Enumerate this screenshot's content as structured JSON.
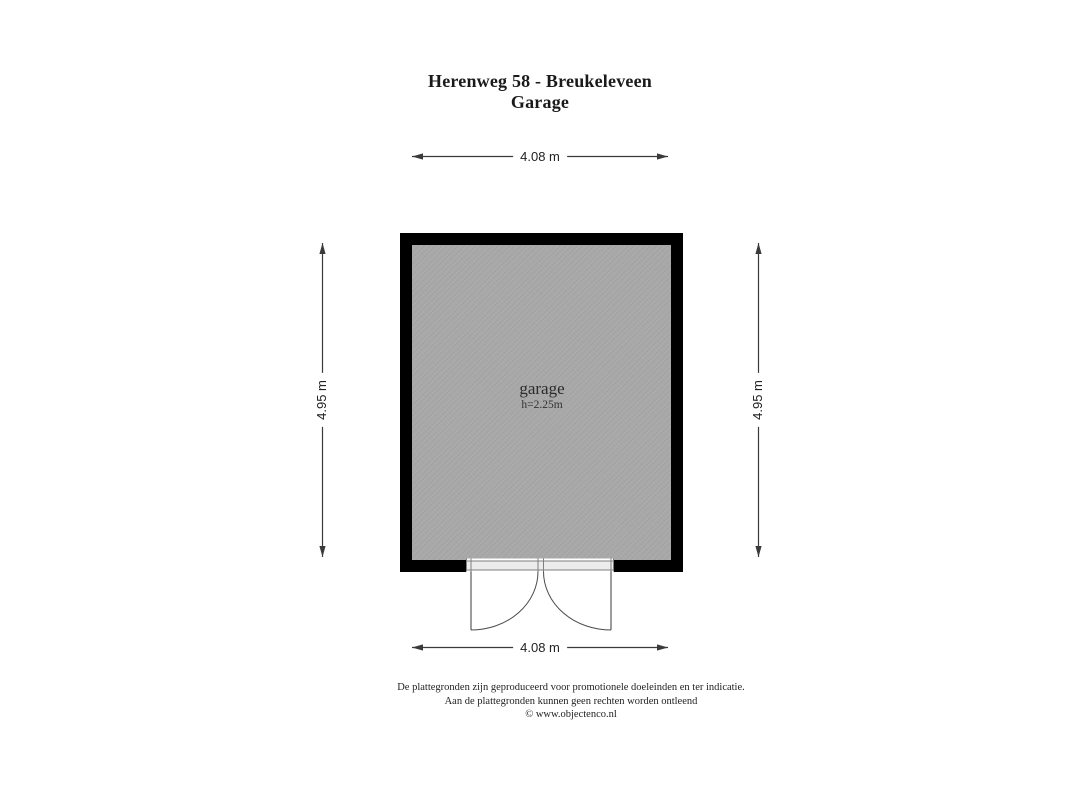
{
  "title": {
    "line1": "Herenweg 58 - Breukeleveen",
    "line2": "Garage"
  },
  "floorplan": {
    "room": {
      "label": "garage",
      "ceiling_height": "h=2.25m"
    },
    "dimensions": {
      "width_top": "4.08 m",
      "width_bottom": "4.08 m",
      "height_left": "4.95 m",
      "height_right": "4.95 m"
    },
    "features": {
      "door": "double-outward-swing-door"
    },
    "colors": {
      "wall": "#000000",
      "floor": "#a8a8a8",
      "dimension_line": "#3a3a3a"
    }
  },
  "footer": {
    "line1": "De plattegronden zijn geproduceerd voor promotionele doeleinden en ter indicatie.",
    "line2": "Aan de plattegronden kunnen geen rechten worden ontleend",
    "line3": "© www.objectenco.nl"
  }
}
